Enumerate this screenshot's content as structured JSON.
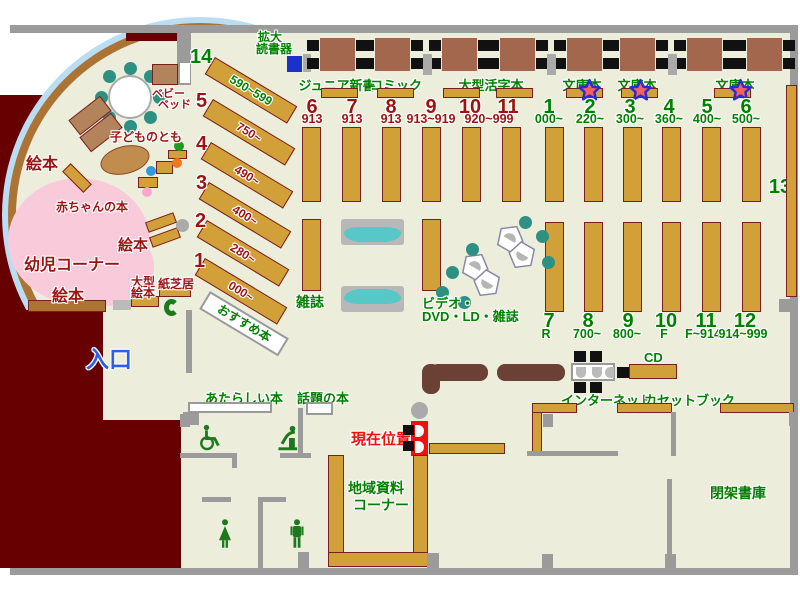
{
  "map_type": "library-floor-map",
  "colors": {
    "floor": "#ECEDDB",
    "exterior": "#670000",
    "wall": "#9B9B9B",
    "shelf": "#D2A039",
    "shelf_border": "#7A1F1F",
    "table": "#A2674C",
    "counter": "#6B4136",
    "teal_chair": "#2E9083",
    "bench_teal": "#57C7C7",
    "toddler_pink": "#F8CADA",
    "glass_band": "#B9DDF2",
    "curved_wall": "#AC7434",
    "label_green": "#008000",
    "label_darkred": "#9B1313",
    "current_red": "#EE1111",
    "entrance_blue": "#2B5DF0",
    "reader_blue": "#1733CC"
  },
  "children_area": {
    "corner_label": "幼児コーナー",
    "picture_books_1": "絵本",
    "picture_books_2": "絵本",
    "picture_books_3": "絵本",
    "baby_books": "赤ちゃんの本",
    "kodomo_no_tomo": "子どものとも",
    "baby_bed": [
      "ベビー",
      "ベッド"
    ],
    "large_picture_books": [
      "大型",
      "絵本"
    ],
    "kamishibai": "紙芝居"
  },
  "entrance": {
    "label": "入口"
  },
  "reader": {
    "label": [
      "拡大",
      "読書器"
    ]
  },
  "recommended": {
    "label": "おすすめ本"
  },
  "diagonal_shelves": [
    {
      "no": "14",
      "range": "590~599",
      "color": "green"
    },
    {
      "no": "5",
      "range": "750~",
      "color": "darkred"
    },
    {
      "no": "4",
      "range": "490~",
      "color": "darkred"
    },
    {
      "no": "3",
      "range": "400~",
      "color": "darkred"
    },
    {
      "no": "2",
      "range": "280~",
      "color": "darkred"
    },
    {
      "no": "1",
      "range": "000~",
      "color": "darkred"
    }
  ],
  "seating_sections": [
    {
      "label": "ジュニア新書",
      "star": false
    },
    {
      "label": "コミック",
      "star": false
    },
    {
      "label": "大型活字本",
      "star": false
    },
    {
      "label": "文庫本",
      "star": true
    },
    {
      "label": "文庫本",
      "star": true
    },
    {
      "label": "文庫本",
      "star": true
    }
  ],
  "stacks": {
    "group_913": {
      "numbers": [
        "6",
        "7",
        "8",
        "9",
        "10",
        "11"
      ],
      "ranges": [
        "913",
        "913",
        "913",
        "913~919",
        "920~999"
      ],
      "color": "darkred"
    },
    "group_general": {
      "numbers": [
        "1",
        "2",
        "3",
        "4",
        "5",
        "6"
      ],
      "ranges": [
        "000~",
        "220~",
        "300~",
        "360~",
        "400~",
        "500~"
      ],
      "color": "green"
    },
    "group_bottom": {
      "numbers": [
        "7",
        "8",
        "9",
        "10",
        "11",
        "12"
      ],
      "ranges": [
        "R",
        "700~",
        "800~",
        "F",
        "F~914",
        "914~999"
      ],
      "color": "green"
    },
    "right_shelf_no": "13"
  },
  "magazines": {
    "label": "雑誌"
  },
  "av_corner": {
    "label": [
      "ビデオ・",
      "DVD・LD・雑誌"
    ]
  },
  "new_books": {
    "label": "あたらしい本"
  },
  "topic_books": {
    "label": "話題の本"
  },
  "current_location": {
    "label": "現在位置"
  },
  "local_materials": {
    "label": [
      "地域資料",
      "コーナー"
    ]
  },
  "internet": {
    "label": "インターネット"
  },
  "cd": {
    "label": "CD"
  },
  "cassette": {
    "label": "カセットブック"
  },
  "closed_stacks": {
    "label": "閉架書庫"
  },
  "icons": {
    "wheelchair": "wheelchair-icon",
    "fountain": "drinking-fountain-icon",
    "woman": "womens-toilet-icon",
    "man": "mens-toilet-icon",
    "phone": "public-phone-icon",
    "star": "star-marker-icon",
    "reader_machine": "magnifier-reader-icon"
  }
}
